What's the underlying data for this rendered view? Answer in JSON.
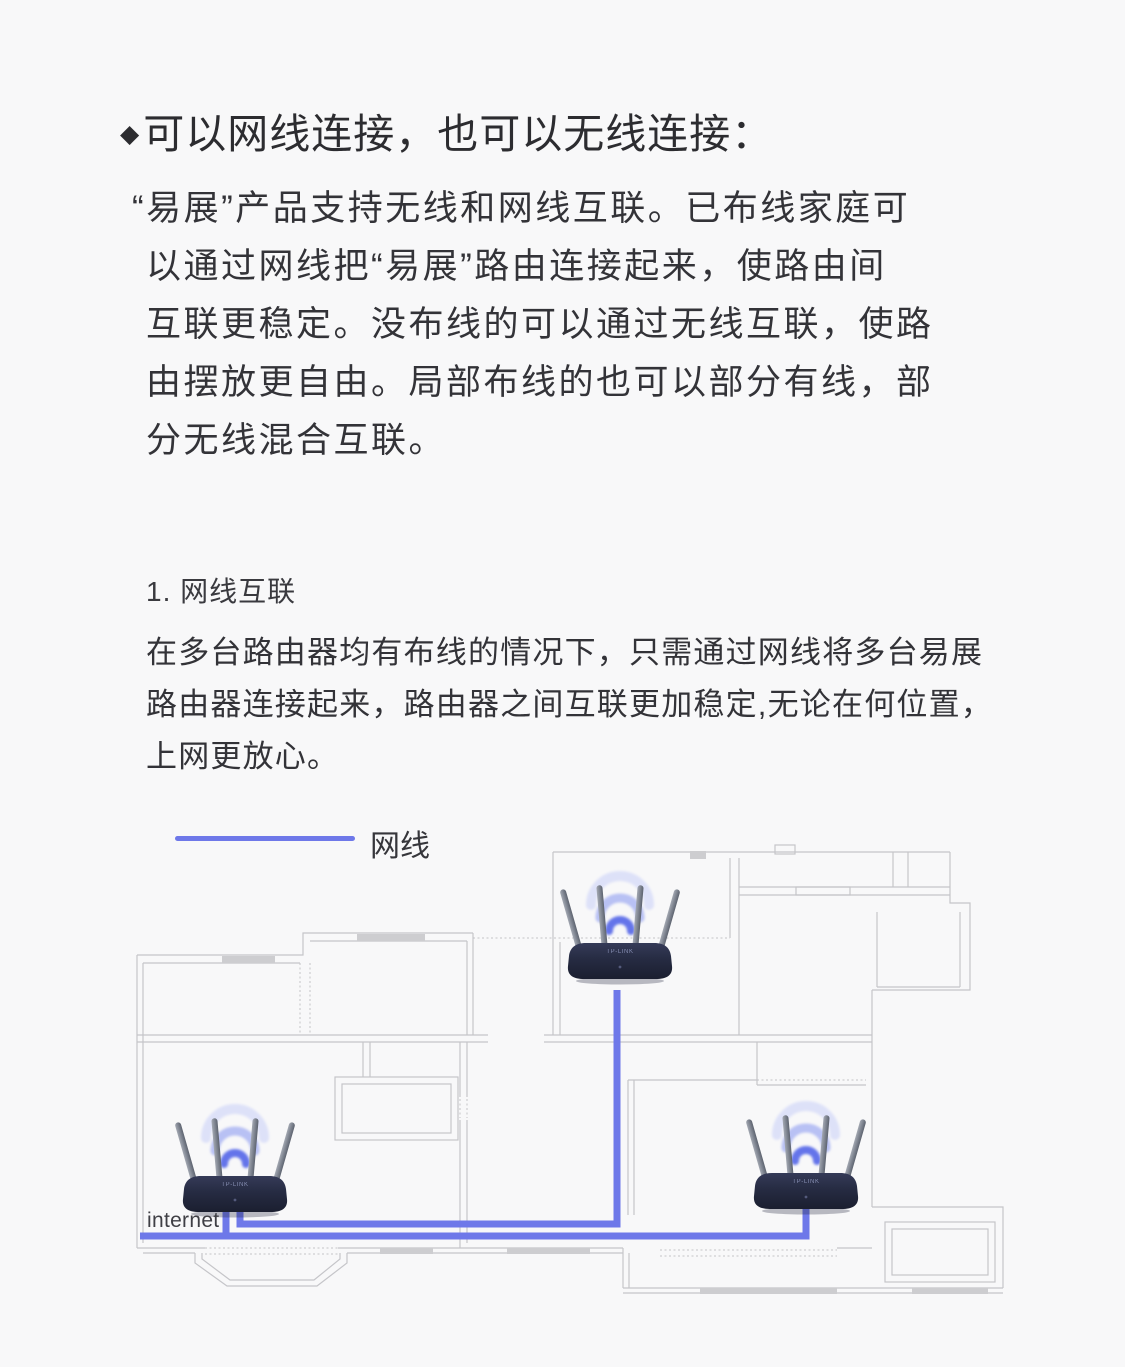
{
  "colors": {
    "bg": "#f8f8f9",
    "text": "#333338",
    "heading": "#2c2c30",
    "cable": "#6e78e9",
    "wall": "#c5c5c9",
    "wallfill": "#cdcdd0",
    "label": "#3f3f45"
  },
  "heading": {
    "bullet": "◆",
    "text": "可以网线连接，也可以无线连接："
  },
  "intro": {
    "lines": [
      "“易展”产品支持无线和网线互联。已布线家庭可",
      "以通过网线把“易展”路由连接起来，使路由间",
      "互联更稳定。没布线的可以通过无线互联，使路",
      "由摆放更自由。局部布线的也可以部分有线，部",
      "分无线混合互联。"
    ]
  },
  "section": {
    "title": "1. 网线互联",
    "lines": [
      "在多台路由器均有布线的情况下，只需通过网线将多台易展",
      "路由器连接起来，路由器之间互联更加稳定,无论在何位置，",
      "上网更放心。"
    ]
  },
  "legend": {
    "label": "网线",
    "color": "#6e78e9"
  },
  "diagram": {
    "internet_label": "internet",
    "router_label": "TP-LINK",
    "cable_color": "#6e78e9",
    "routers": [
      "top-bedroom",
      "bottom-left-living-room",
      "bottom-right-bedroom"
    ],
    "connections": [
      "internet → bottom-left router",
      "bottom-left router → top router",
      "bottom-left router → bottom-right router"
    ]
  }
}
